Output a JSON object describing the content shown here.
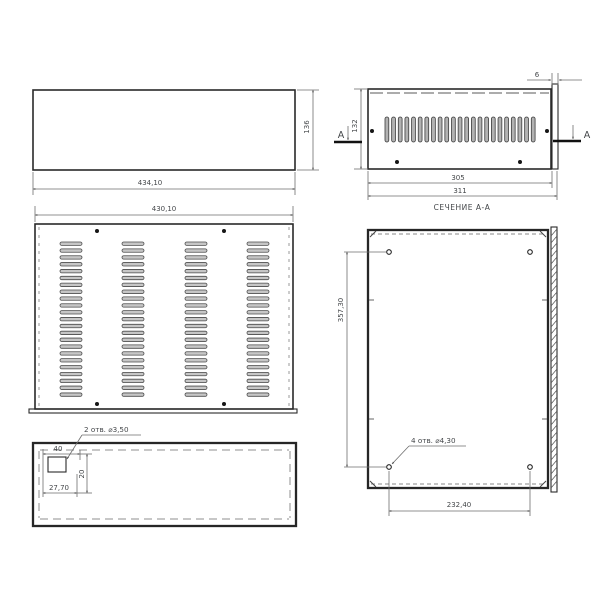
{
  "colors": {
    "background": "#ffffff",
    "outline": "#2a2a2a",
    "dimension_line": "#6e6e6e",
    "text": "#44474a"
  },
  "views": {
    "side": {
      "width": "434,10",
      "height": "136"
    },
    "section": {
      "label": "СЕЧЕНИЕ А-А",
      "marker": "A",
      "flange": "6",
      "height": "132",
      "inner_width": "305",
      "outer_width": "311",
      "slot_count": 23
    },
    "top": {
      "width": "430,10",
      "vent_columns": 4,
      "slats_per_column": 23
    },
    "front": {
      "note": "2 отв. ⌀3,50",
      "width": "40",
      "offset": "27,70",
      "height": "20"
    },
    "panel": {
      "note": "4 отв. ⌀4,30",
      "height": "357,30",
      "width": "232,40"
    }
  }
}
